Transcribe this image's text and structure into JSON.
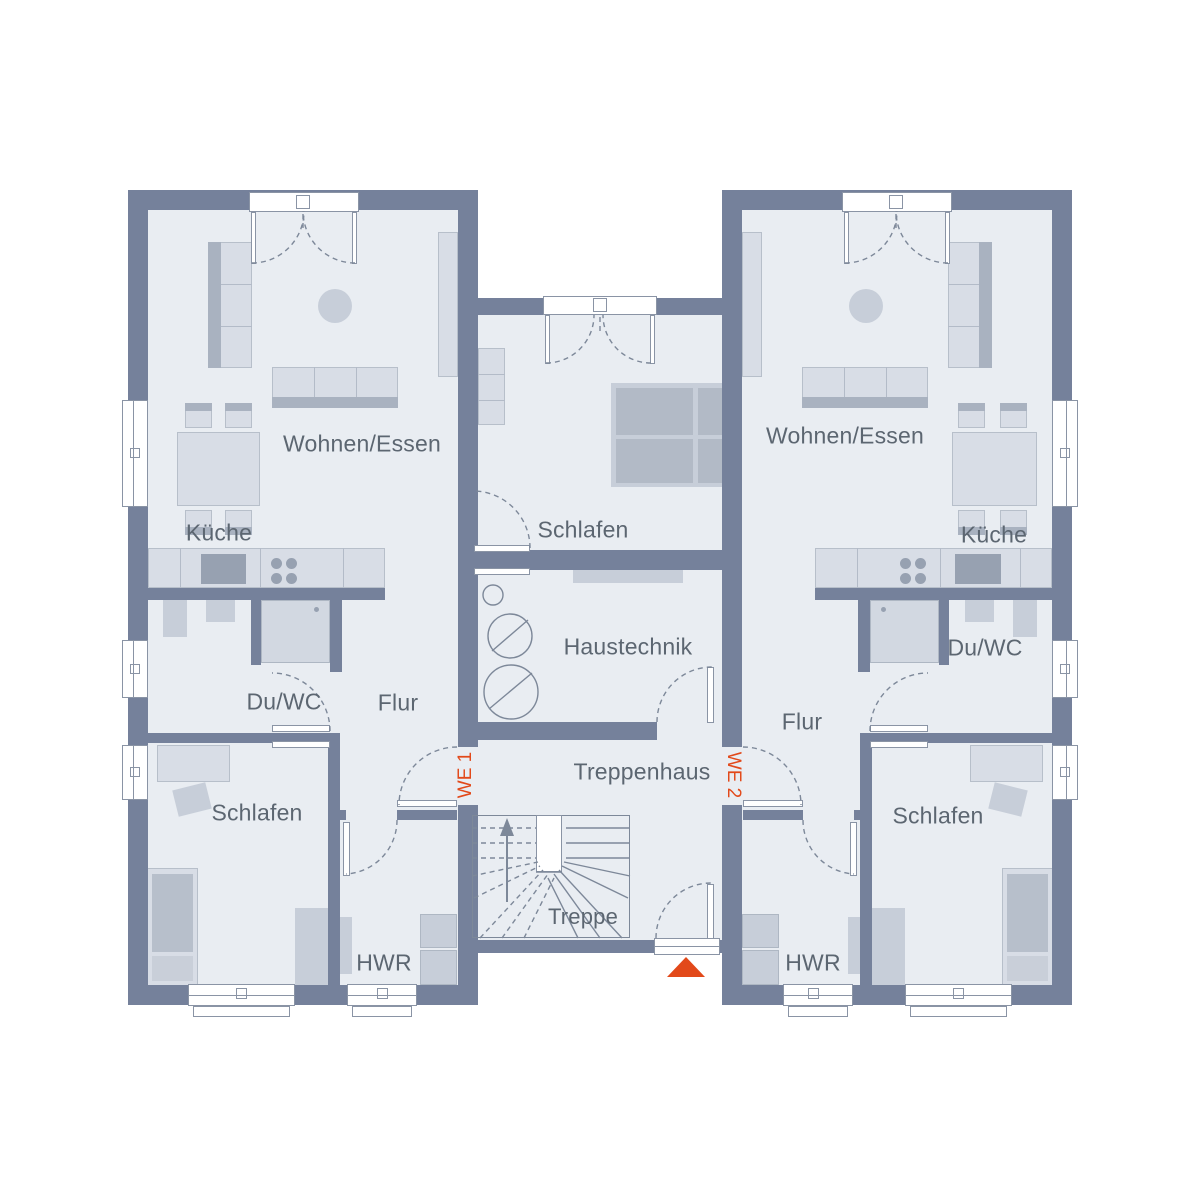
{
  "floorplan": {
    "type": "residential floor plan, two mirrored apartments around central staircase",
    "unit_markers": {
      "we1": "WE 1",
      "we2": "WE 2"
    },
    "rooms": {
      "wohnen_essen_left": "Wohnen/Essen",
      "kueche_left": "Küche",
      "du_wc_left": "Du/WC",
      "flur_left": "Flur",
      "schlafen_left": "Schlafen",
      "hwr_left": "HWR",
      "schlafen_center": "Schlafen",
      "haustechnik": "Haustechnik",
      "treppenhaus": "Treppenhaus",
      "treppe": "Treppe",
      "wohnen_essen_right": "Wohnen/Essen",
      "kueche_right": "Küche",
      "du_wc_right": "Du/WC",
      "flur_right": "Flur",
      "schlafen_right": "Schlafen",
      "hwr_right": "HWR"
    },
    "colors": {
      "wall": "#75819B",
      "floor": "#E9EDF2",
      "furn_light": "#D8DDE6",
      "furn_mid": "#C7CED9",
      "furn_dark": "#A9B2C0",
      "pan": "#D2D8E1",
      "appliance": "#97A1B1",
      "outline": "#8A94A5",
      "stroke": "#7D8899",
      "text": "#5C6671",
      "orange": "#E2491A"
    }
  }
}
